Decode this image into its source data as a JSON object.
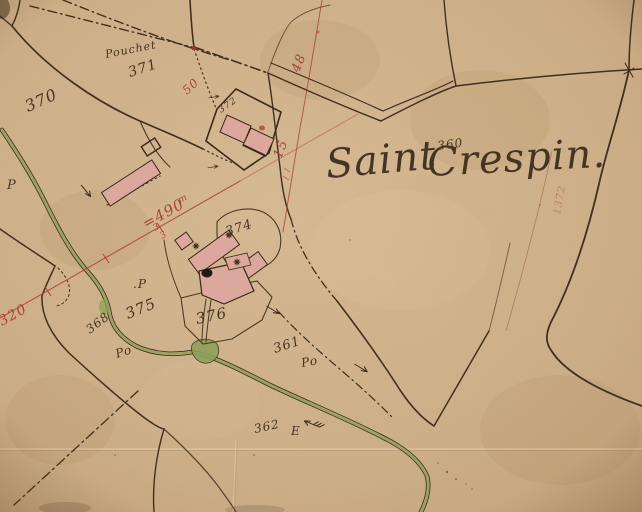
{
  "map": {
    "type": "historic-cadastral-map",
    "title": "Saint Crespin.",
    "title_parcel_number": "360",
    "place_name": "Pouchet"
  },
  "colors": {
    "paper": "#cfb089",
    "ink": "#463422",
    "road": "#41301e",
    "red": "#ab4237",
    "red_faint": "#9a5a47",
    "green": "#8ea157",
    "building_fill": "#dca79c",
    "building_stroke": "#3a2a18"
  },
  "labels": [
    {
      "text": "Saint",
      "x": 327,
      "y": 178,
      "size": 40,
      "rot": -5,
      "color": "ink"
    },
    {
      "text": "Crespin.",
      "x": 428,
      "y": 176,
      "size": 40,
      "rot": -3,
      "color": "ink"
    },
    {
      "text": "360",
      "x": 438,
      "y": 150,
      "size": 12,
      "rot": -8,
      "color": "ink"
    },
    {
      "text": "370",
      "x": 28,
      "y": 112,
      "size": 16,
      "rot": -24,
      "color": "ink"
    },
    {
      "text": "Pouchet",
      "x": 106,
      "y": 58,
      "size": 11,
      "rot": -11,
      "color": "ink"
    },
    {
      "text": "371",
      "x": 130,
      "y": 77,
      "size": 14,
      "rot": -18,
      "color": "ink"
    },
    {
      "text": "372",
      "x": 221,
      "y": 113,
      "size": 9,
      "rot": -35,
      "color": "ink"
    },
    {
      "text": "374",
      "x": 227,
      "y": 236,
      "size": 13,
      "rot": -18,
      "color": "ink"
    },
    {
      "text": "375",
      "x": 128,
      "y": 319,
      "size": 15,
      "rot": -22,
      "color": "ink"
    },
    {
      "text": "376",
      "x": 197,
      "y": 324,
      "size": 15,
      "rot": -12,
      "color": "ink"
    },
    {
      "text": "368",
      "x": 90,
      "y": 334,
      "size": 12,
      "rot": -38,
      "color": "ink"
    },
    {
      "text": "Po",
      "x": 117,
      "y": 358,
      "size": 12,
      "rot": -18,
      "color": "ink"
    },
    {
      "text": "361",
      "x": 275,
      "y": 353,
      "size": 13,
      "rot": -18,
      "color": "ink"
    },
    {
      "text": "Po",
      "x": 302,
      "y": 367,
      "size": 12,
      "rot": -10,
      "color": "ink"
    },
    {
      "text": "362",
      "x": 255,
      "y": 433,
      "size": 12,
      "rot": -12,
      "color": "ink"
    },
    {
      "text": "E",
      "x": 291,
      "y": 435,
      "size": 12,
      "rot": 0,
      "color": "ink"
    },
    {
      "text": "P",
      "x": 7,
      "y": 189,
      "size": 13,
      "rot": 0,
      "color": "ink"
    },
    {
      "text": ".P",
      "x": 133,
      "y": 288,
      "size": 12,
      "rot": 0,
      "color": "ink"
    },
    {
      "text": "320",
      "x": 2,
      "y": 326,
      "size": 14,
      "rot": -29,
      "color": "red"
    },
    {
      "text": "=490",
      "x": 146,
      "y": 229,
      "size": 15,
      "rot": -29,
      "color": "red"
    },
    {
      "text": "m",
      "x": 180,
      "y": 203,
      "size": 9,
      "rot": -29,
      "color": "red"
    },
    {
      "text": "50",
      "x": 187,
      "y": 95,
      "size": 12,
      "rot": -42,
      "color": "red"
    },
    {
      "text": "48",
      "x": 299,
      "y": 73,
      "size": 13,
      "rot": -68,
      "color": "red"
    },
    {
      "text": "15",
      "x": 281,
      "y": 159,
      "size": 13,
      "rot": -68,
      "color": "red"
    },
    {
      "text": "3",
      "x": 155,
      "y": 231,
      "size": 9,
      "rot": -29,
      "color": "red"
    },
    {
      "text": "3",
      "x": 162,
      "y": 239,
      "size": 9,
      "rot": -29,
      "color": "red"
    },
    {
      "text": "1372",
      "x": 560,
      "y": 215,
      "size": 10,
      "rot": -80,
      "color": "red",
      "opacity": 0.45
    }
  ]
}
